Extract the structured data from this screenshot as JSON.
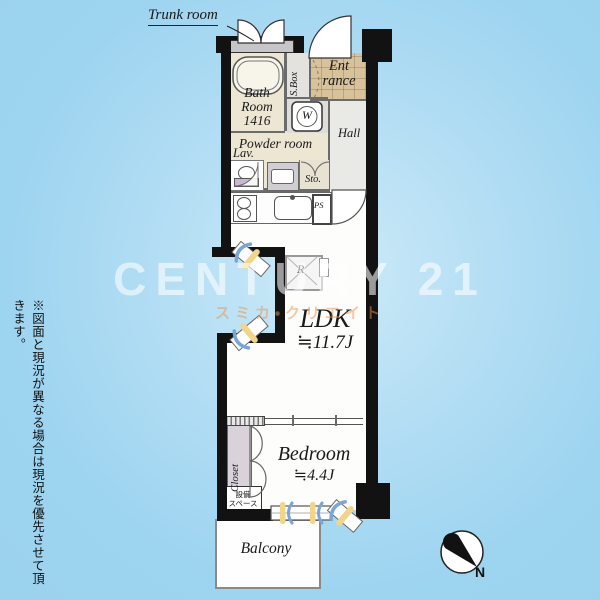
{
  "watermark": {
    "brand": "CENTURY 21",
    "subtitle": "スミカ・クリエイト"
  },
  "disclaimer": "※図面と現況が異なる場合は現況を優先させて頂きます。",
  "plan": {
    "trunk_label": "Trunk room",
    "bath": {
      "name": "Bath Room",
      "size": "1416"
    },
    "shoe_box": "S.Box",
    "entrance": "Ent rance",
    "washer": "W",
    "powder_room": "Powder room",
    "lavatory": "Lav.",
    "storage": "Sto.",
    "hall": "Hall",
    "pipe_space": "PS",
    "refrigerator": "R",
    "ldk": {
      "name": "LDK",
      "size": "≒11.7J"
    },
    "closet": "Closet",
    "equipment_space": {
      "line1": "設備",
      "line2": "スペース"
    },
    "bedroom": {
      "name": "Bedroom",
      "size": "≒4.4J"
    },
    "balcony": "Balcony",
    "compass_north": "N"
  },
  "colors": {
    "background_blue": "#9dd4f0",
    "wall_black": "#121212",
    "room_cream": "#ece6d3",
    "entrance_tan": "#d8c29c",
    "hall_gray": "#e9e9e6",
    "closet_gray": "#d9d2da",
    "window_yellow": "#f2d58a",
    "window_blue": "#7aa6d6",
    "watermark_orange": "#e9944a"
  }
}
